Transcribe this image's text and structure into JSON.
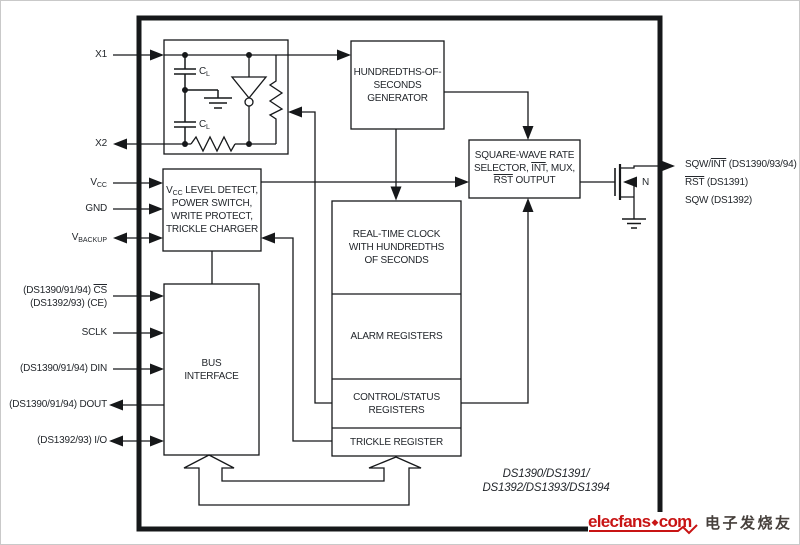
{
  "pins": {
    "left": {
      "x1": "X1",
      "x2": "X2",
      "vcc": {
        "base": "V",
        "sub": "CC"
      },
      "gnd": "GND",
      "vbackup": {
        "base": "V",
        "sub": "BACKUP"
      },
      "cs": {
        "line1_prefix": "(DS1390/91/94) ",
        "line1_overline": "CS",
        "line2": "(DS1392/93) (CE)"
      },
      "sclk": "SCLK",
      "din": "(DS1390/91/94) DIN",
      "dout": "(DS1390/91/94) DOUT",
      "io": "(DS1392/93) I/O"
    },
    "right": {
      "out1": {
        "prefix": "SQW/",
        "overline": "INT",
        "suffix": " (DS1390/93/94)"
      },
      "out2": {
        "overline": "RST",
        "suffix": " (DS1391)"
      },
      "out3": "SQW (DS1392)",
      "mosfet_label": "N"
    }
  },
  "blocks": {
    "oscillator": {
      "cap1": {
        "base": "C",
        "sub": "L"
      },
      "cap2": {
        "base": "C",
        "sub": "L"
      }
    },
    "generator": {
      "line1": "HUNDREDTHS-OF-",
      "line2": "SECONDS",
      "line3": "GENERATOR"
    },
    "selector": {
      "line1": "SQUARE-WAVE RATE",
      "line2_prefix": "SELECTOR, ",
      "line2_overline": "INT",
      "line2_suffix": ", MUX,",
      "line3_overline": "RST",
      "line3_suffix": " OUTPUT"
    },
    "power": {
      "line1_base": "V",
      "line1_sub": "CC",
      "line1_rest": " LEVEL DETECT,",
      "line2": "POWER SWITCH,",
      "line3": "WRITE PROTECT,",
      "line4": "TRICKLE CHARGER"
    },
    "rtc": {
      "line1": "REAL-TIME CLOCK",
      "line2": "WITH HUNDREDTHS",
      "line3": "OF SECONDS"
    },
    "alarm": {
      "line1": "ALARM REGISTERS"
    },
    "control": {
      "line1": "CONTROL/STATUS",
      "line2": "REGISTERS"
    },
    "trickle": {
      "line1": "TRICKLE REGISTER"
    },
    "bus": {
      "line1": "BUS",
      "line2": "INTERFACE"
    }
  },
  "chip": {
    "part_line1": "DS1390/DS1391/",
    "part_line2": "DS1392/DS1393/DS1394"
  },
  "watermark": {
    "brand": "elecfans",
    "separator": "◆",
    "tld": "com",
    "chinese": "电子发烧友",
    "brand_color": "#c81414",
    "chinese_color": "#46403c"
  }
}
